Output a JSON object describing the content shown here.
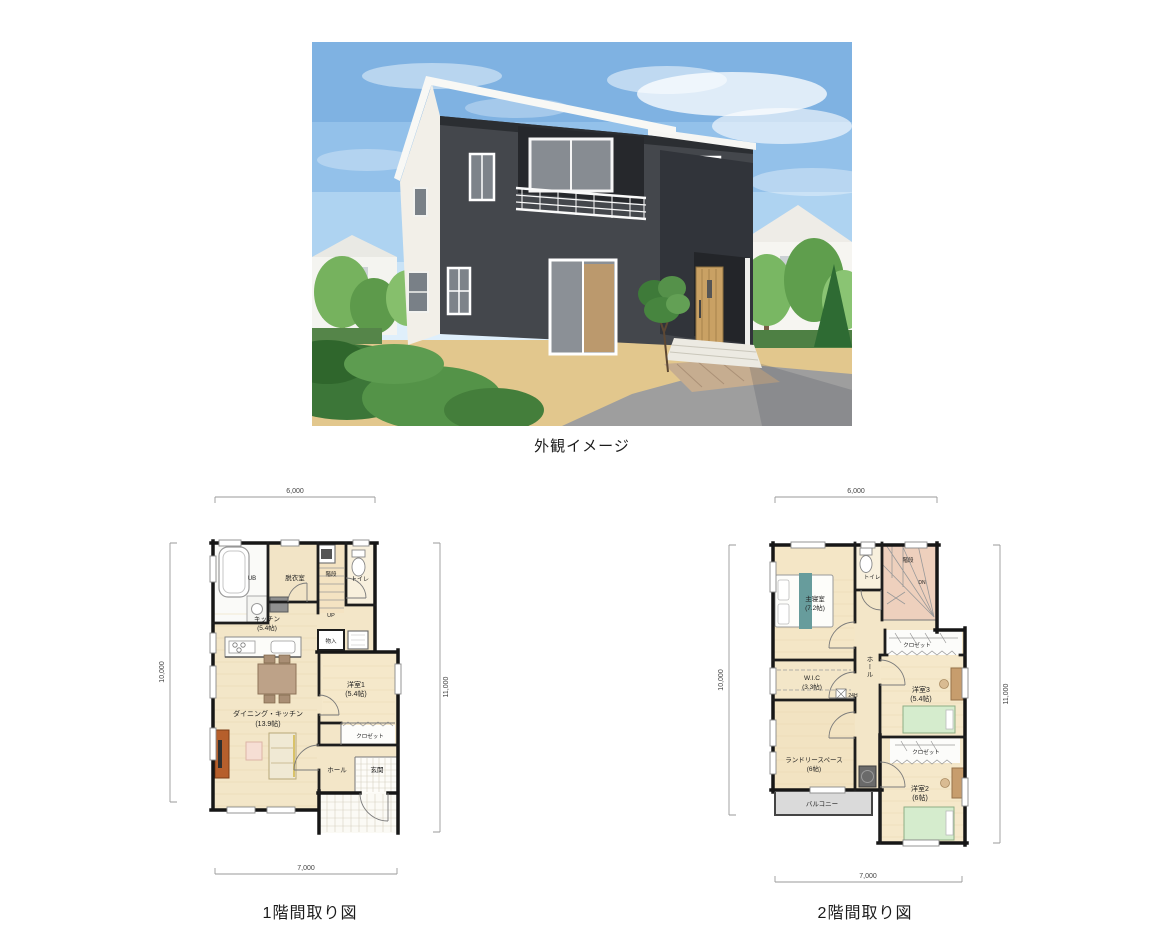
{
  "captions": {
    "exterior": "外観イメージ",
    "floor1": "1階間取り図",
    "floor2": "2階間取り図"
  },
  "floor1": {
    "dims": {
      "top": "6,000",
      "left": "10,000",
      "right": "11,000",
      "bottom": "7,000"
    },
    "labels": {
      "ub": "UB",
      "dressing": "脱衣室",
      "stairs": "階段",
      "up": "UP",
      "toilet": "トイレ",
      "kitchen": "キッチン",
      "kitchen_size": "(5.4帖)",
      "storage": "物入",
      "room1": "洋室1",
      "room1_size": "(5.4帖)",
      "dining_kitchen": "ダイニング・キッチン",
      "dining_kitchen_size": "(13.9帖)",
      "closet": "クロゼット",
      "hall": "ホール",
      "entrance": "玄関"
    }
  },
  "floor2": {
    "dims": {
      "top": "6,000",
      "left": "10,000",
      "right": "11,000",
      "bottom": "7,000"
    },
    "labels": {
      "master": "主寝室",
      "master_size": "(7.2帖)",
      "toilet": "トイレ",
      "stairs": "階段",
      "dn": "DN",
      "wic": "W.I.C",
      "wic_size": "(3.3帖)",
      "hall": "ホール",
      "closet_room3": "クロゼット",
      "room3": "洋室3",
      "room3_size": "(5.4帖)",
      "vent": "24H",
      "laundry": "ランドリースペース",
      "laundry_size": "(6帖)",
      "balcony": "バルコニー",
      "closet_room2": "クロゼット",
      "room2": "洋室2",
      "room2_size": "(6帖)"
    }
  }
}
